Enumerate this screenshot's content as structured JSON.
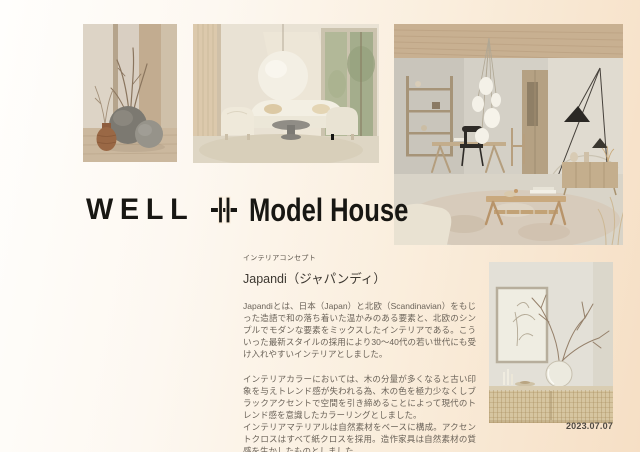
{
  "palette": {
    "bg_left": "#fffdfa",
    "bg_right": "#f6dfc5",
    "ink": "#181713",
    "heading_text": "#3d3831",
    "body_text": "#6b6359",
    "date_text": "#4f4a43"
  },
  "logo": {
    "brand": "WELL",
    "plus_icon": "double-plus-icon",
    "product": "Model House"
  },
  "concept": {
    "label": "インテリアコンセプト",
    "title": "Japandi（ジャパンディ）",
    "paragraphs": [
      "Japandiとは、日本（Japan）と北欧（Scandinavian）をもじった造語で和の落ち着いた温かみのある要素と、北欧のシンプルでモダンな要素をミックスしたインテリアである。こういった最新スタイルの採用により30〜40代の若い世代にも受け入れやすいインテリアとしました。",
      "インテリアカラーにおいては、木の分量が多くなると古い印象を与えトレンド感が失われる為、木の色を極力少なくしブラックアクセントで空間を引き締めることによって現代のトレンド感を意識したカラーリングとしました。",
      "インテリアマテリアルは自然素材をベースに構成。アクセントクロスはすべて紙クロスを採用。造作家具は自然素材の質感を生かしたものとしました。"
    ]
  },
  "footer": {
    "date": "2023.07.07"
  },
  "photos": [
    {
      "name": "vases-still-life"
    },
    {
      "name": "living-room-pendant"
    },
    {
      "name": "dining-living-interior"
    },
    {
      "name": "branch-vase-sideboard"
    }
  ]
}
